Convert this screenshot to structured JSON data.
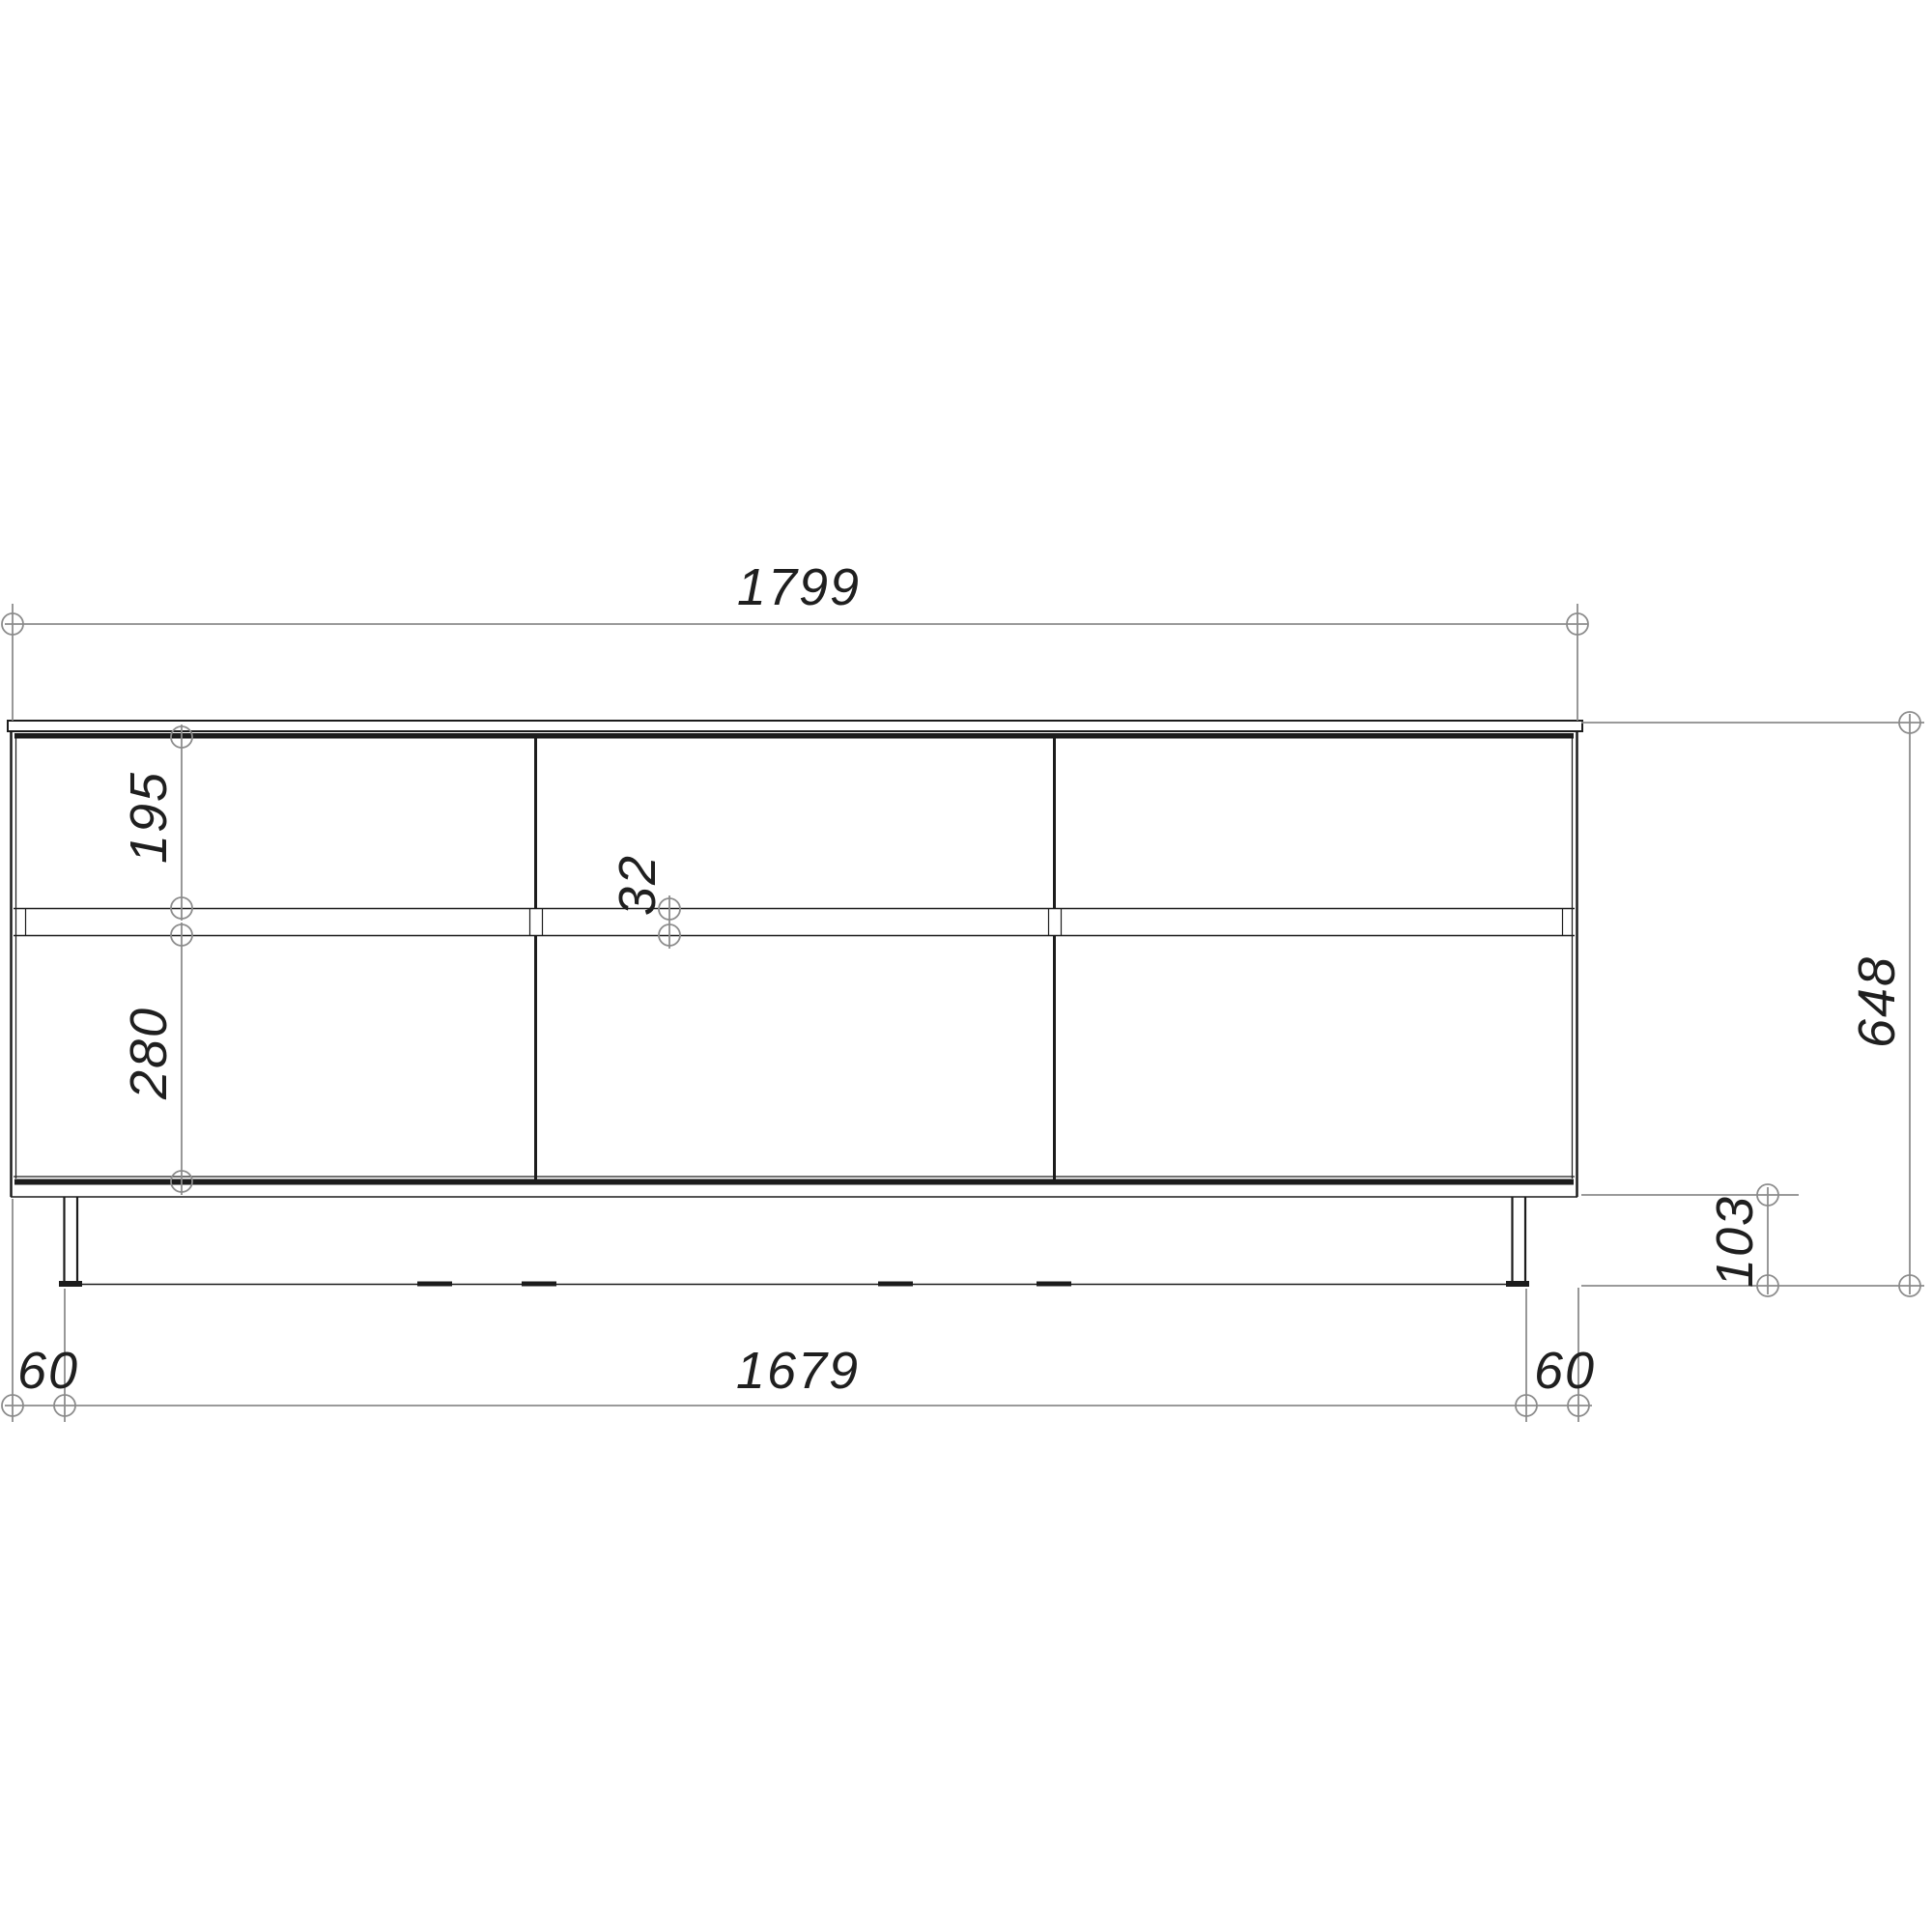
{
  "drawing": {
    "kind": "furniture front-elevation dimension drawing",
    "colors": {
      "outline": "#1c1c1c",
      "dimension": "#8c8c8c",
      "background": "#ffffff"
    }
  },
  "dimensions": {
    "overall_width": "1799",
    "overall_height": "648",
    "drawer_front_height": "195",
    "door_front_height": "280",
    "gap_between_fronts": "32",
    "leg_height": "103",
    "leg_inset_left": "60",
    "leg_span": "1679",
    "leg_inset_right": "60"
  }
}
